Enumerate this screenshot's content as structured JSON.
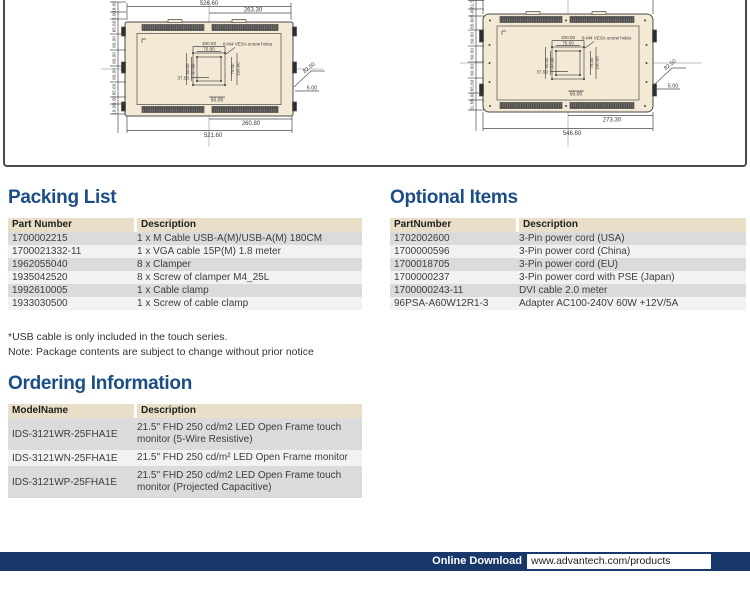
{
  "colors": {
    "heading": "#1b4e86",
    "footer_bar": "#18386b",
    "table_header_bg": "#e9dfc8",
    "row_dark": "#dbdbdb",
    "row_light": "#f3f2f0",
    "panel_fill": "#f3e9d5",
    "line": "#4a4a4a"
  },
  "drawings": {
    "left": {
      "dim_total_w": "526.60",
      "dim_half_w": "263.30",
      "dim_half_w_b": "260.80",
      "dim_total_w_b": "521.60",
      "side": [
        "19.00",
        "5.00",
        "65.60",
        "60.00",
        "60.00",
        "60.00",
        "65.60",
        "5.00",
        "19.00"
      ],
      "v100": "100.00",
      "v75": "75.00",
      "v50": "50.00",
      "v37": "37.50",
      "r75": "75.00",
      "r100": "100.00",
      "c37": "37.50",
      "b50": "50.00",
      "vesa_note": "8-M4 VESA screw holes",
      "call_a": "82.50",
      "call_b": "5.00"
    },
    "right": {
      "dim_half_w_b": "273.30",
      "dim_total_w_b": "546.60",
      "side": [
        "31.5",
        "5.00",
        "65.60",
        "60.00",
        "60.00",
        "60.00",
        "65.60",
        "5.00",
        "31.50"
      ],
      "v100": "100.00",
      "v75": "75.00",
      "v50": "50.00",
      "v37": "37.50",
      "r75": "75.00",
      "r100": "100.00",
      "c37": "37.50",
      "b50": "50.00",
      "vesa_note": "8-M4 VESA screw holes",
      "call_a": "82.50",
      "call_b": "5.00"
    }
  },
  "packing_list": {
    "title": "Packing List",
    "headers": [
      "Part Number",
      "Description"
    ],
    "rows": [
      [
        "1700002215",
        "1 x M Cable USB-A(M)/USB-A(M) 180CM"
      ],
      [
        "1700021332-11",
        "1 x VGA cable 15P(M) 1.8 meter"
      ],
      [
        "1962055040",
        "8 x Clamper"
      ],
      [
        "1935042520",
        "8 x Screw of clamper M4_25L"
      ],
      [
        "1992610005",
        "1 x Cable clamp"
      ],
      [
        "1933030500",
        "1 x Screw of cable clamp"
      ]
    ],
    "notes": [
      "*USB cable is only included in the touch series.",
      "Note: Package contents are subject to change without prior notice"
    ]
  },
  "optional_items": {
    "title": "Optional Items",
    "headers": [
      "PartNumber",
      "Description"
    ],
    "rows": [
      [
        "1702002600",
        "3-Pin power cord (USA)"
      ],
      [
        "1700000596",
        "3-Pin power cord (China)"
      ],
      [
        "1700018705",
        "3-Pin power cord (EU)"
      ],
      [
        "1700000237",
        "3-Pin power cord with PSE (Japan)"
      ],
      [
        "1700000243-11",
        "DVI cable 2.0 meter"
      ],
      [
        "96PSA-A60W12R1-3",
        "Adapter AC100-240V 60W +12V/5A"
      ]
    ]
  },
  "ordering": {
    "title": "Ordering Information",
    "headers": [
      "ModelName",
      "Description"
    ],
    "rows": [
      [
        "IDS-3121WR-25FHA1E",
        "21.5\" FHD 250 cd/m2 LED Open Frame touch monitor (5-Wire Resistive)"
      ],
      [
        "IDS-3121WN-25FHA1E",
        "21.5\" FHD 250 cd/m² LED Open Frame monitor"
      ],
      [
        "IDS-3121WP-25FHA1E",
        "21.5\" FHD 250 cd/m2 LED Open Frame touch monitor (Projected Capacitive)"
      ]
    ]
  },
  "footer": {
    "label": "Online Download",
    "url": "www.advantech.com/products"
  }
}
